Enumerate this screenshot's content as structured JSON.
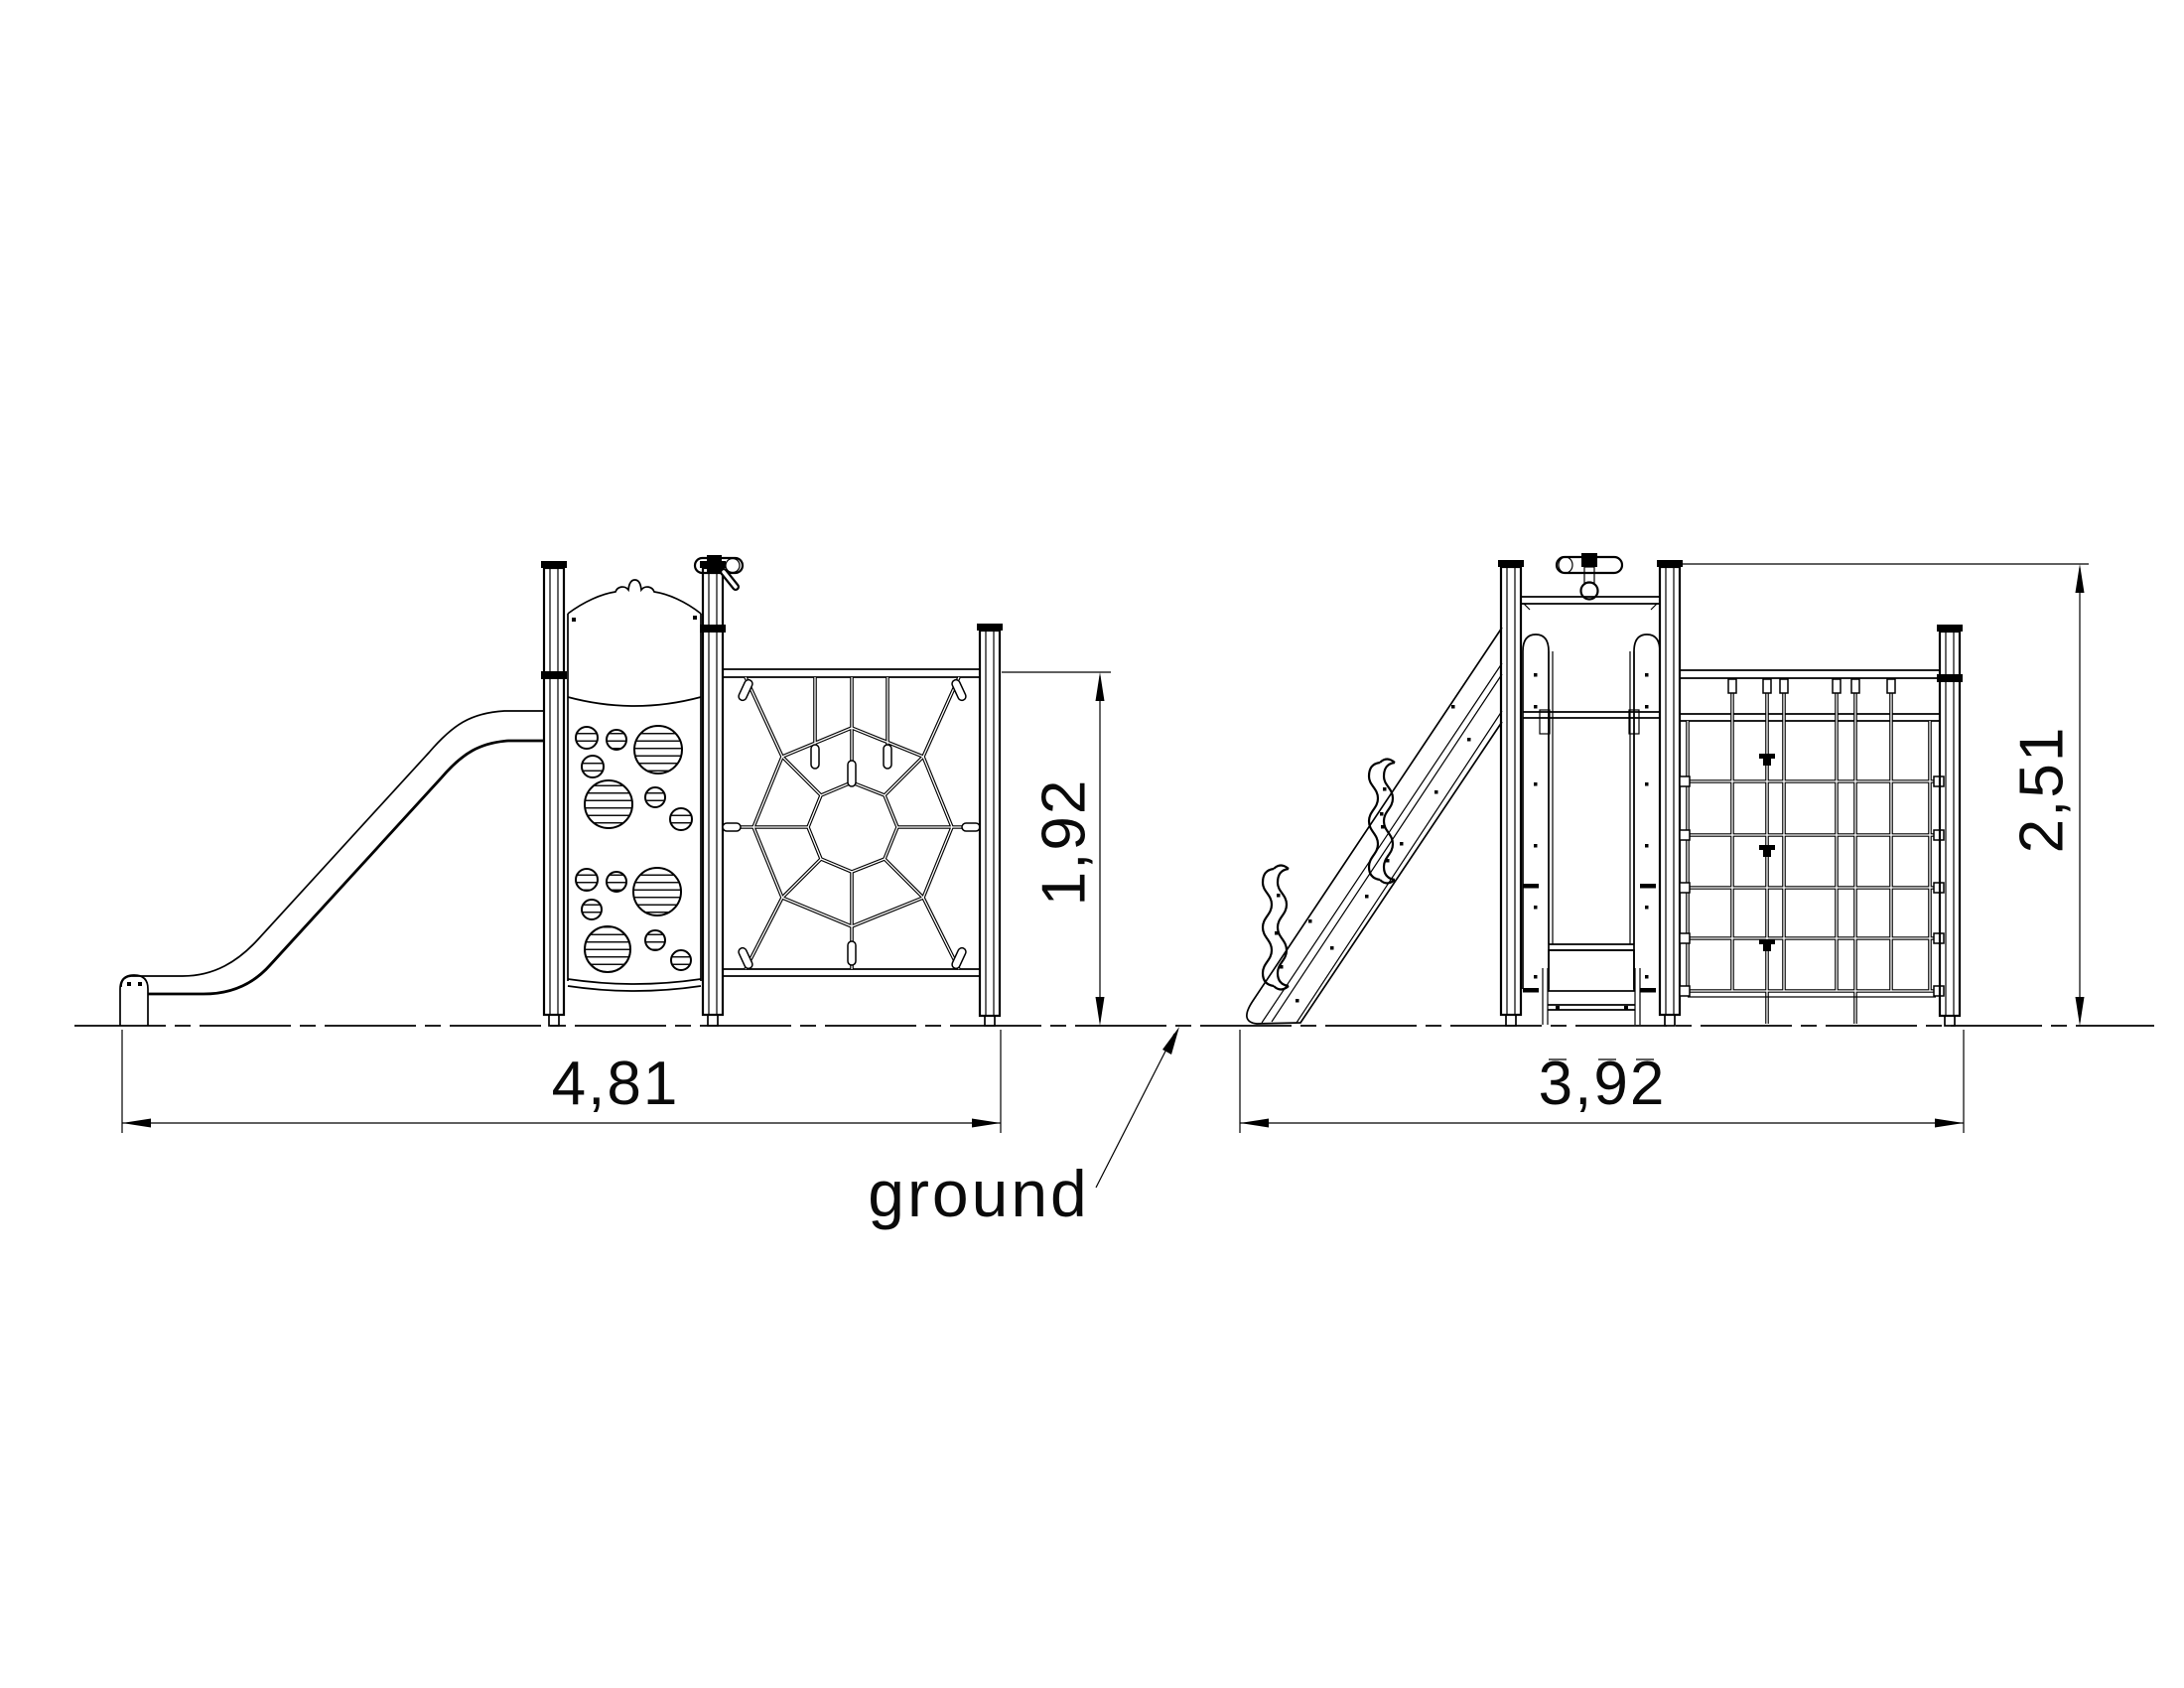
{
  "document": {
    "type": "playground-equipment-elevation-drawing",
    "background_color": "#ffffff",
    "line_color": "#000000"
  },
  "views": {
    "side": {
      "name": "side-elevation",
      "components": [
        "slide",
        "hole-climbing-panel",
        "spider-net-climbing-panel"
      ],
      "width_label": "4,81",
      "height_label": "1,92"
    },
    "front": {
      "name": "front-elevation",
      "components": [
        "stairs",
        "tower-with-handle-bar",
        "grid-climbing-net"
      ],
      "width_label": "3,92",
      "height_label": "2,51"
    }
  },
  "labels": {
    "ground": "ground"
  }
}
